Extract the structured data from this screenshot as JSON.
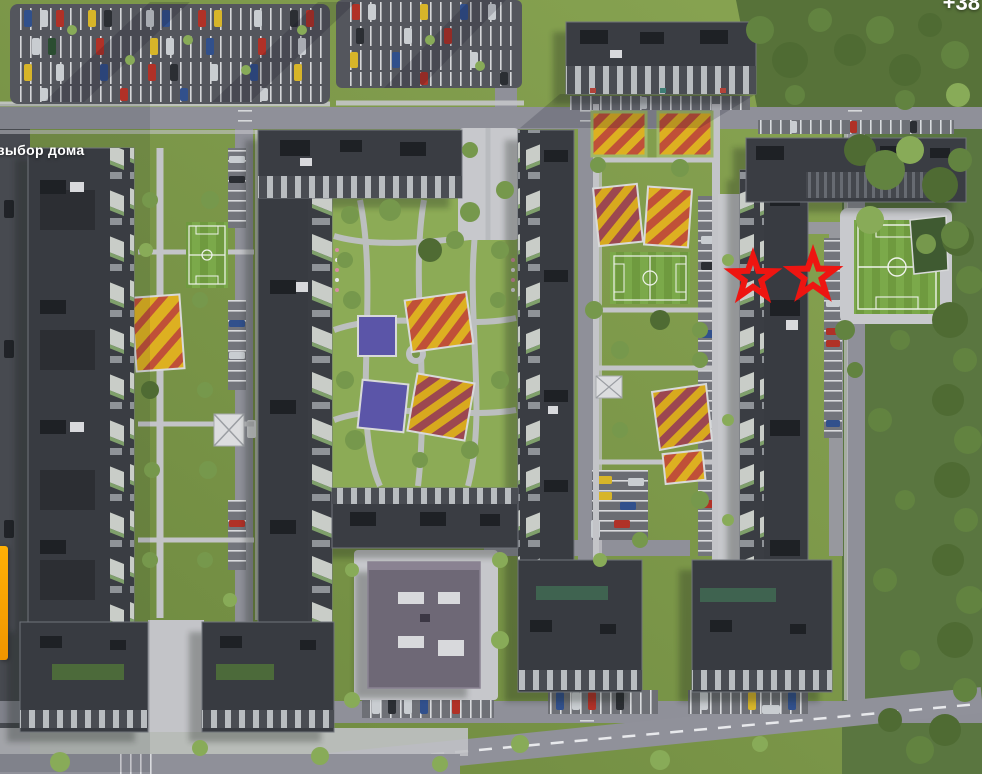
{
  "overlay": {
    "house_select_label": "выбор дома",
    "top_right_partial_text": "+38",
    "label_color": "#ffffff",
    "left_edge_accent_color": "#ffb005"
  },
  "markers": {
    "color": "#ee1511",
    "stars": [
      {
        "x": 753,
        "y": 278,
        "outer_radius": 31,
        "inner_radius": 13
      },
      {
        "x": 813,
        "y": 276,
        "outer_radius": 32,
        "inner_radius": 13.5
      }
    ]
  },
  "scene": {
    "palette": {
      "grass": "#7d9a4a",
      "forest": "#5a7640",
      "road": "#8f9099",
      "parking_asphalt": "#54565d",
      "building_roof": "#383b41",
      "school_roof": "#6e6876",
      "football_field": "#6f9a3f",
      "playground_yellow": "#ddb021",
      "playground_red": "#c05038",
      "playground_blue": "#5b55a8",
      "playground_maroon": "#9c4750"
    }
  }
}
